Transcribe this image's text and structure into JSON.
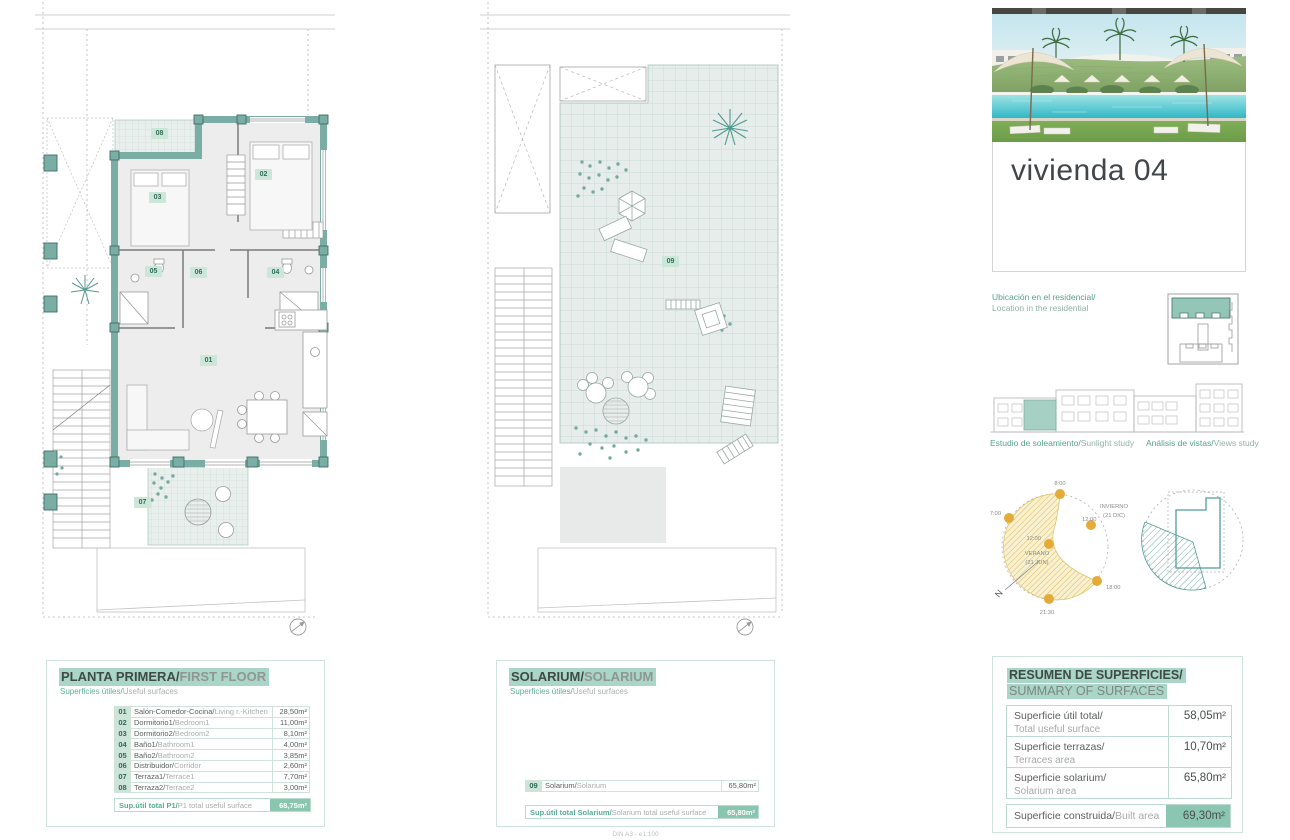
{
  "unit": {
    "title": "vivienda 04"
  },
  "location": {
    "label_es": "Ubicación en el residencial/",
    "label_en": "Location in the residential"
  },
  "studies": {
    "sunlight": {
      "title_es": "Estudio de soleamiento/",
      "title_en": "Sunlight study",
      "time_top": "8:00",
      "time_left": "7:00",
      "time_center": "12:00",
      "time_right": "12:00",
      "time_evening": "18:00",
      "time_late": "21:30",
      "summer_label": "VERANO",
      "summer_date": "(21 JUN)",
      "winter_label": "INVIERNO",
      "winter_date": "(21 DIC)",
      "north_label": "N"
    },
    "views": {
      "title_es": "Análisis de vistas/",
      "title_en": "Views study"
    }
  },
  "first_floor": {
    "title_es": "PLANTA PRIMERA/",
    "title_en": "FIRST FLOOR",
    "subtitle_es": "Superficies útiles/",
    "subtitle_en": "Useful surfaces",
    "rows": [
      {
        "num": "01",
        "name_es": "Salón-Comedor-Cocina/",
        "name_en": "Living r.-Kitchen",
        "value": "28,50m²"
      },
      {
        "num": "02",
        "name_es": "Dormitorio1/",
        "name_en": "Bedroom1",
        "value": "11,00m²"
      },
      {
        "num": "03",
        "name_es": "Dormitorio2/",
        "name_en": "Bedroom2",
        "value": "8,10m²"
      },
      {
        "num": "04",
        "name_es": "Baño1/",
        "name_en": "Bathroom1",
        "value": "4,00m²"
      },
      {
        "num": "05",
        "name_es": "Baño2/",
        "name_en": "Bathroom2",
        "value": "3,85m²"
      },
      {
        "num": "06",
        "name_es": "Distribuidor/",
        "name_en": "Corridor",
        "value": "2,60m²"
      },
      {
        "num": "07",
        "name_es": "Terraza1/",
        "name_en": "Terrace1",
        "value": "7,70m²"
      },
      {
        "num": "08",
        "name_es": "Terraza2/",
        "name_en": "Terrace2",
        "value": "3,00m²"
      }
    ],
    "total_label_es": "Sup.útil total P1/",
    "total_label_en": "P1 total useful surface",
    "total_value": "68,75m²"
  },
  "solarium": {
    "title_es": "SOLARIUM/",
    "title_en": "SOLARIUM",
    "subtitle_es": "Superficies útiles/",
    "subtitle_en": "Useful surfaces",
    "rows": [
      {
        "num": "09",
        "name_es": "Solarium/",
        "name_en": "Solarium",
        "value": "65,80m²"
      }
    ],
    "total_label_es": "Sup.útil total Solarium/",
    "total_label_en": "Solarium total useful surface",
    "total_value": "65,80m²"
  },
  "summary": {
    "title_es": "RESUMEN DE SUPERFICIES/",
    "title_en": "SUMMARY OF SURFACES",
    "rows": [
      {
        "label_es": "Superficie útil total/",
        "label_en": "Total useful surface",
        "value": "58,05m²"
      },
      {
        "label_es": "Superficie terrazas/",
        "label_en": "Terraces area",
        "value": "10,70m²"
      },
      {
        "label_es": "Superficie solarium/",
        "label_en": "Solarium area",
        "value": "65,80m²"
      }
    ],
    "built": {
      "label_es": "Superficie construida/",
      "label_en": "Built area",
      "value": "69,30m²"
    }
  },
  "page": {
    "scale_note": "DIN A3 - e1:100"
  },
  "colors": {
    "wall_teal": "#7aaea4",
    "highlight": "#a9d6c6",
    "total_bg": "#89c5af",
    "sun_dot": "#e5ab38",
    "views_teal": "#4f9e96"
  }
}
